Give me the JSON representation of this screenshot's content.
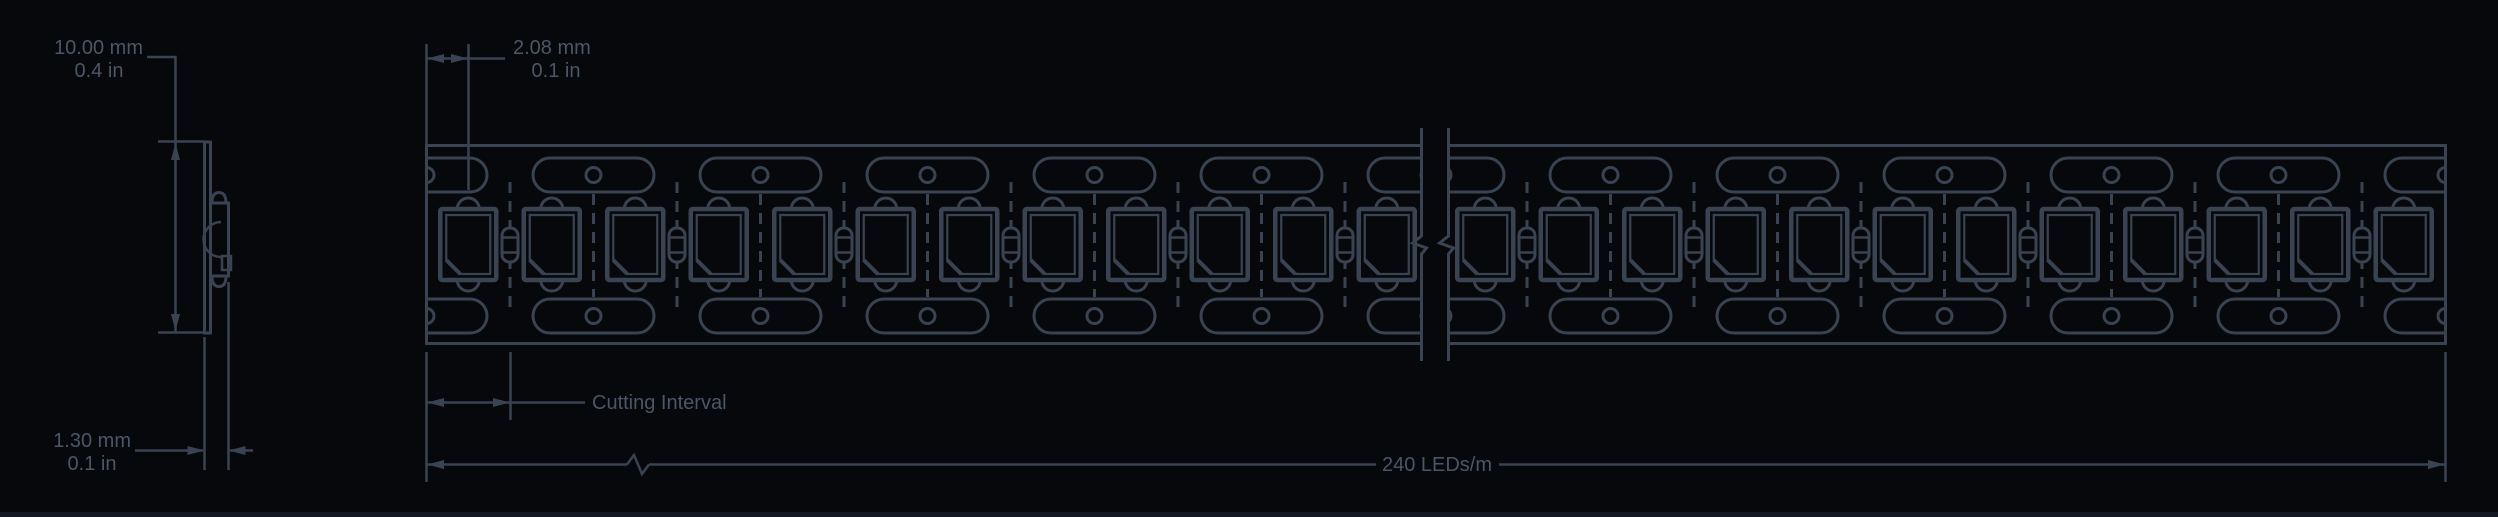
{
  "drawing": {
    "title": "LED strip dimensional drawing",
    "views": [
      "side-profile",
      "top-view"
    ]
  },
  "labels": {
    "strip_width_mm": "10.00 mm",
    "strip_width_in": "0.4 in",
    "led_pitch_mm": "2.08 mm",
    "led_pitch_in": "0.1 in",
    "strip_thickness_mm": "1.30 mm",
    "strip_thickness_in": "0.1 in",
    "cutting_interval": "Cutting Interval",
    "led_density": "240 LEDs/m"
  },
  "values": {
    "leds_per_meter": 240,
    "strip_width_mm": 10.0,
    "led_pitch_mm": 2.08,
    "strip_thickness_mm": 1.3
  },
  "colors": {
    "background": "#06080b",
    "line": "#3a4351",
    "text": "#4c5668",
    "footer": "#131823"
  },
  "geometry": {
    "strip": {
      "left": 426.5,
      "right": 2445.5,
      "top": 145.5,
      "bottom": 343.5,
      "break_left": 1421.5,
      "break_right": 1448.5
    },
    "pattern": {
      "group_pitch": 167,
      "led_pitch": 83.5,
      "groups_per_section": 7,
      "leds_per_section": 12,
      "capsules_per_section": 6,
      "oval": {
        "half_len": 60.5,
        "top_y": 158,
        "bot_y": 299,
        "h": 34,
        "rx": 17,
        "circle_r": 7.5
      },
      "package": {
        "w": 56,
        "h": 71,
        "top": 209,
        "bump_r": 11,
        "inner_inset": 6,
        "chamfer": 14
      },
      "capsule": {
        "w": 16,
        "h": 34,
        "top": 228,
        "rx": 7.5
      }
    },
    "side_view": {
      "pcb_x": 204.5,
      "pcb_w": 6,
      "pcb_top": 142,
      "pcb_bottom": 333,
      "pkg_left": 210.5,
      "pkg_right": 228.5,
      "pkg_top": 203,
      "pkg_bottom": 276
    }
  }
}
